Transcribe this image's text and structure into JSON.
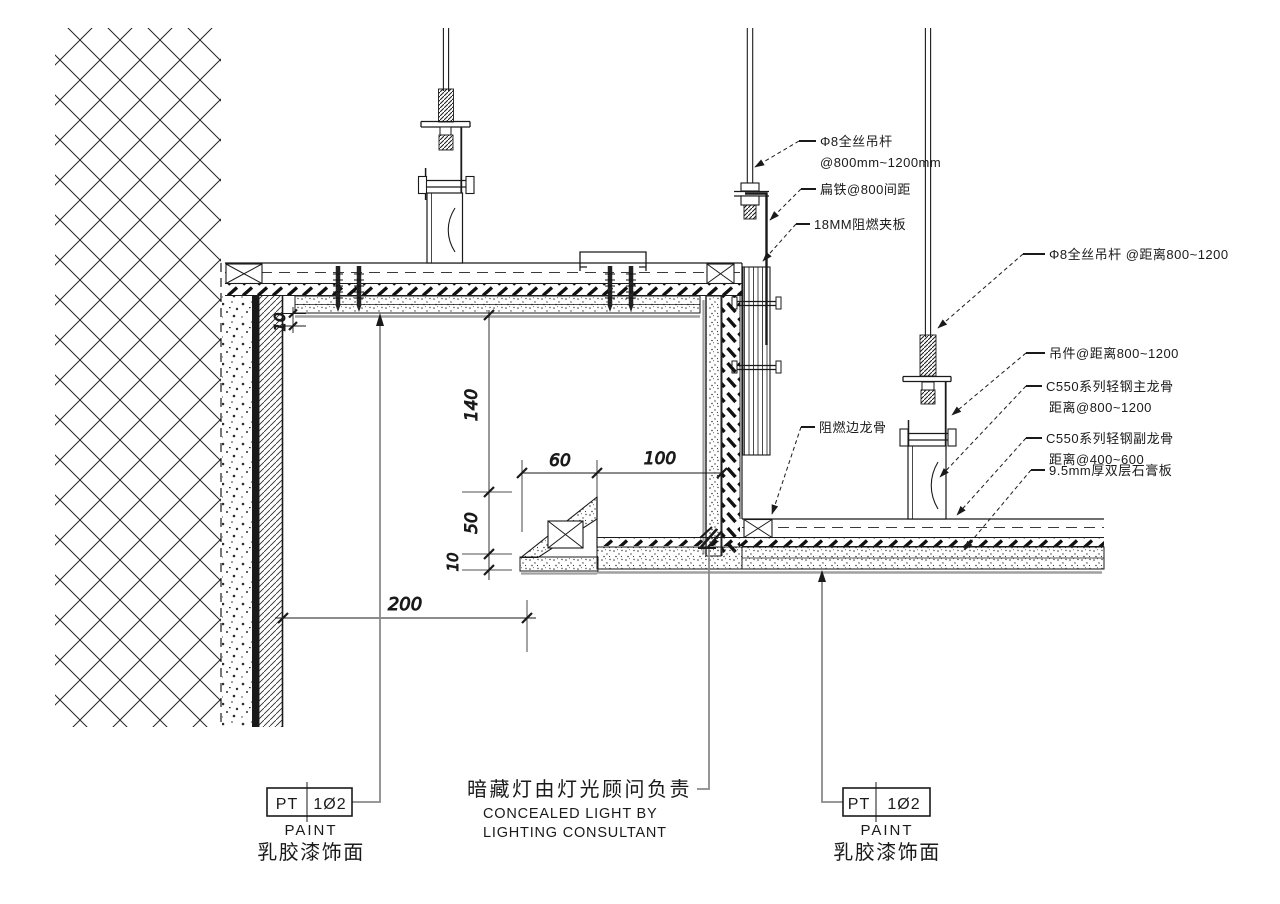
{
  "colors": {
    "ink": "#1a1a1a",
    "shadow": "#a0a0a0",
    "leader_gray": "#8a8a8a"
  },
  "callouts": {
    "rod_top": {
      "l1": "Φ8全丝吊杆",
      "l2": "@800mm~1200mm"
    },
    "flat_iron": {
      "l1": "扁铁@800间距"
    },
    "plywood": {
      "l1": "18MM阻燃夹板"
    },
    "rod_right": {
      "l1": "Φ8全丝吊杆 @距离800~1200"
    },
    "clip": {
      "l1": "吊件@距离800~1200"
    },
    "main_keel": {
      "l1": "C550系列轻钢主龙骨",
      "l2": "距离@800~1200"
    },
    "sub_keel": {
      "l1": "C550系列轻钢副龙骨",
      "l2": "距离@400~600"
    },
    "gypsum": {
      "l1": "9.5mm厚双层石膏板"
    },
    "edge_keel": {
      "l1": "阻燃边龙骨"
    }
  },
  "dimensions": {
    "gap10": "10",
    "h140": "140",
    "h50": "50",
    "t10": "10",
    "w60": "60",
    "w100": "100",
    "w200": "200"
  },
  "finish_tags": {
    "left": {
      "code": "PT",
      "num": "1Ø2",
      "en": "PAINT",
      "cn": "乳胶漆饰面"
    },
    "right": {
      "code": "PT",
      "num": "1Ø2",
      "en": "PAINT",
      "cn": "乳胶漆饰面"
    }
  },
  "note": {
    "cn": "暗藏灯由灯光顾问负责",
    "en1": "CONCEALED LIGHT BY",
    "en2": "LIGHTING CONSULTANT"
  }
}
